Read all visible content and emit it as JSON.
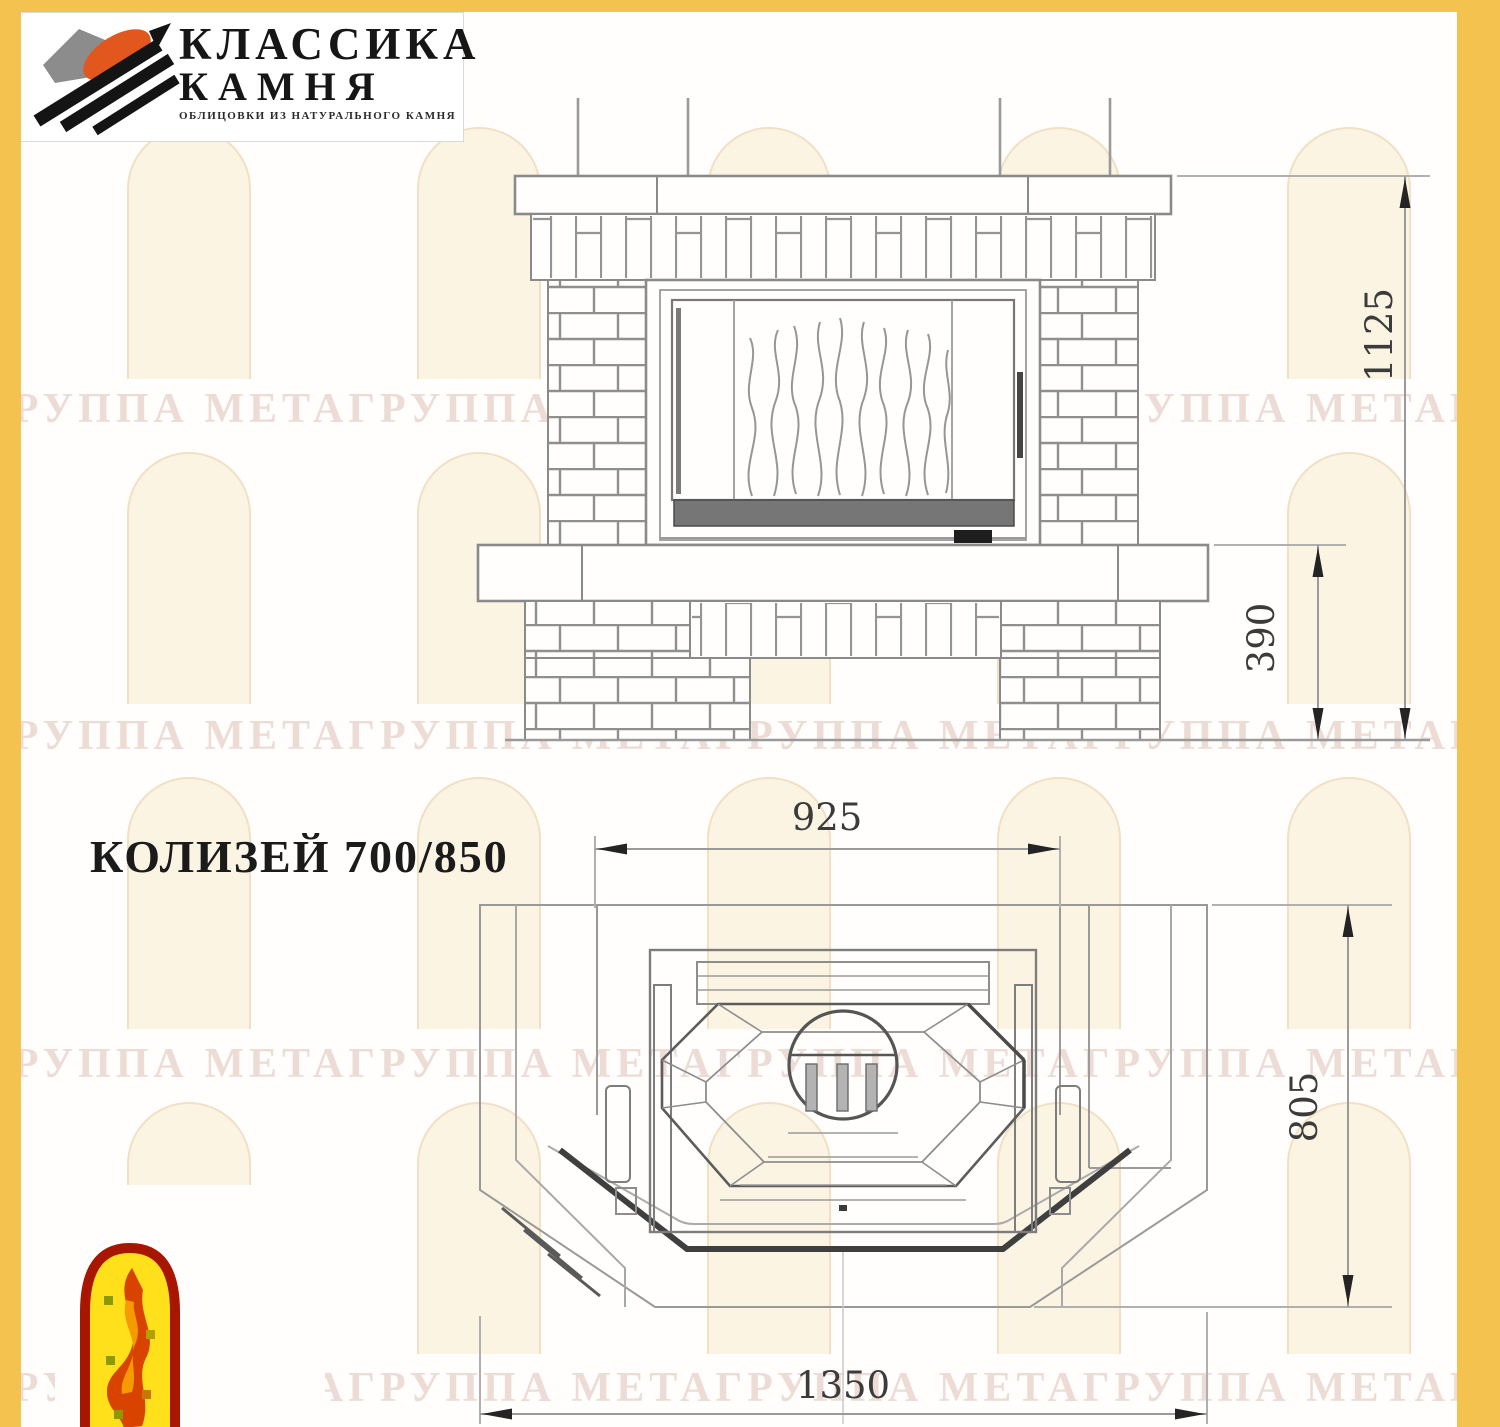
{
  "logo": {
    "line1": "КЛАССИКА",
    "line2": "КАМНЯ",
    "caption": "ОБЛИЦОВКИ ИЗ НАТУРАЛЬНОГО КАМНЯ"
  },
  "title": "КОЛИЗЕЙ 700/850",
  "watermark": {
    "row_text": "ГРУППА МЕТАГРУППА МЕТАГРУППА МЕТАГРУППА МЕТАГРУППА"
  },
  "dimensions": {
    "front_total_height": "1125",
    "front_base_height": "390",
    "plan_top_width": "925",
    "plan_depth": "805",
    "plan_total_width": "1350"
  },
  "colors": {
    "frame_yellow": "#f3c24f",
    "line_gray": "#8d8d8d",
    "dark_line": "#3f3f3f"
  }
}
